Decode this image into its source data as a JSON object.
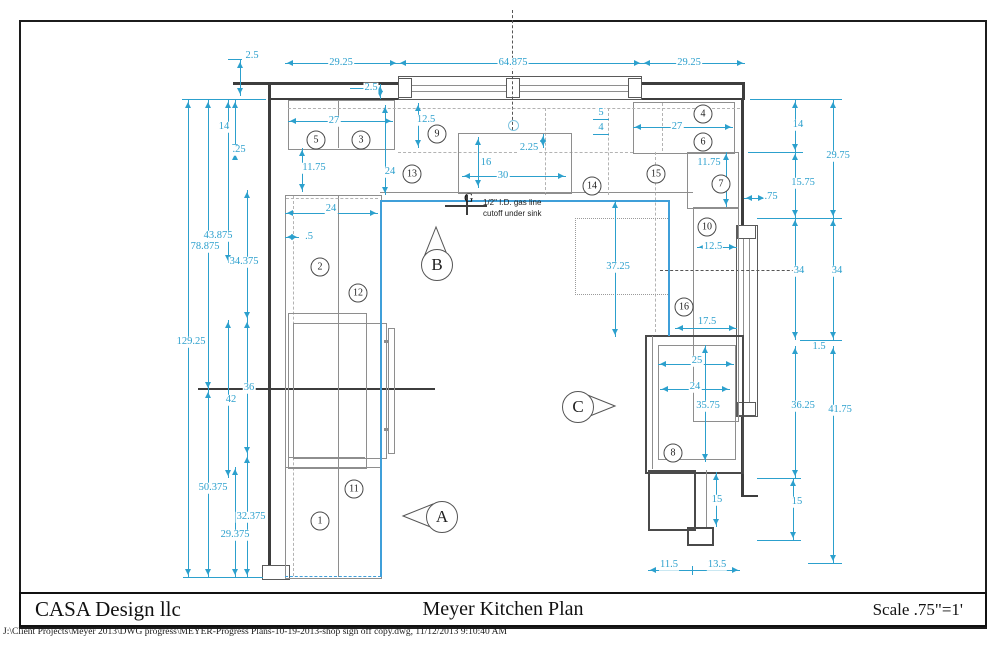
{
  "title_block": {
    "company": "CASA Design llc",
    "title": "Meyer Kitchen Plan",
    "scale": "Scale .75\"=1'"
  },
  "footer": {
    "path": "J:\\Client Projects\\Meyer 2013\\DWG progress\\MEYER-Progress Plans-10-19-2013-shop sign off copy.dwg, 11/12/2013 9:10:40 AM"
  },
  "gas_note": {
    "marker": "G",
    "line1": "1/2\" I.D. gas line",
    "line2": "cutoff under sink"
  },
  "colors": {
    "dimension_cyan": "#2ca0cd",
    "counter_blue": "#3f9fd9",
    "wall_dark": "#3d3d3d"
  },
  "section_markers": [
    {
      "label": "A",
      "dir": "left",
      "x": 441,
      "y": 516
    },
    {
      "label": "B",
      "dir": "up",
      "x": 436,
      "y": 264
    },
    {
      "label": "C",
      "dir": "right",
      "x": 577,
      "y": 406
    }
  ],
  "item_bubbles": [
    {
      "n": "1",
      "x": 320,
      "y": 521
    },
    {
      "n": "2",
      "x": 320,
      "y": 267
    },
    {
      "n": "3",
      "x": 361,
      "y": 140
    },
    {
      "n": "4",
      "x": 703,
      "y": 114
    },
    {
      "n": "5",
      "x": 316,
      "y": 140
    },
    {
      "n": "6",
      "x": 703,
      "y": 142
    },
    {
      "n": "7",
      "x": 721,
      "y": 184
    },
    {
      "n": "8",
      "x": 673,
      "y": 453
    },
    {
      "n": "9",
      "x": 437,
      "y": 134
    },
    {
      "n": "10",
      "x": 707,
      "y": 227
    },
    {
      "n": "11",
      "x": 354,
      "y": 489
    },
    {
      "n": "12",
      "x": 358,
      "y": 293
    },
    {
      "n": "13",
      "x": 412,
      "y": 174
    },
    {
      "n": "14",
      "x": 592,
      "y": 186
    },
    {
      "n": "15",
      "x": 656,
      "y": 174
    },
    {
      "n": "16",
      "x": 684,
      "y": 307
    }
  ],
  "dimensions": [
    {
      "t": "2.5",
      "x": 252,
      "y": 56
    },
    {
      "t": "29.25",
      "x": 341,
      "y": 63
    },
    {
      "t": "64.875",
      "x": 513,
      "y": 63
    },
    {
      "t": "29.25",
      "x": 689,
      "y": 63
    },
    {
      "t": "2.5",
      "x": 371,
      "y": 88
    },
    {
      "t": "27",
      "x": 334,
      "y": 121
    },
    {
      "t": "12.5",
      "x": 426,
      "y": 120
    },
    {
      "t": "11.75",
      "x": 314,
      "y": 168
    },
    {
      "t": "24",
      "x": 390,
      "y": 172
    },
    {
      "t": "16",
      "x": 486,
      "y": 163
    },
    {
      "t": "30",
      "x": 503,
      "y": 176
    },
    {
      "t": "2.25",
      "x": 529,
      "y": 148
    },
    {
      "t": "5",
      "x": 601,
      "y": 113
    },
    {
      "t": "4",
      "x": 601,
      "y": 128
    },
    {
      "t": "27",
      "x": 677,
      "y": 127
    },
    {
      "t": "11.75",
      "x": 709,
      "y": 163
    },
    {
      "t": ".75",
      "x": 771,
      "y": 197
    },
    {
      "t": "14",
      "x": 224,
      "y": 127
    },
    {
      "t": ".25",
      "x": 239,
      "y": 150
    },
    {
      "t": "43.875",
      "x": 218,
      "y": 236
    },
    {
      "t": "78.875",
      "x": 205,
      "y": 247
    },
    {
      "t": "34.375",
      "x": 244,
      "y": 262
    },
    {
      "t": "129.25",
      "x": 191,
      "y": 342
    },
    {
      "t": "36",
      "x": 249,
      "y": 388
    },
    {
      "t": "42",
      "x": 231,
      "y": 400
    },
    {
      "t": "50.375",
      "x": 213,
      "y": 488
    },
    {
      "t": "32.375",
      "x": 251,
      "y": 517
    },
    {
      "t": "29.375",
      "x": 235,
      "y": 535
    },
    {
      "t": "24",
      "x": 331,
      "y": 209
    },
    {
      "t": ".5",
      "x": 309,
      "y": 237
    },
    {
      "t": "12.5",
      "x": 713,
      "y": 247
    },
    {
      "t": "37.25",
      "x": 618,
      "y": 267
    },
    {
      "t": "17.5",
      "x": 707,
      "y": 322
    },
    {
      "t": "25",
      "x": 697,
      "y": 361
    },
    {
      "t": "24",
      "x": 695,
      "y": 387
    },
    {
      "t": "35.75",
      "x": 708,
      "y": 406
    },
    {
      "t": "15",
      "x": 717,
      "y": 500
    },
    {
      "t": "11.5",
      "x": 669,
      "y": 565
    },
    {
      "t": "13.5",
      "x": 717,
      "y": 565
    },
    {
      "t": "14",
      "x": 798,
      "y": 125
    },
    {
      "t": "29.75",
      "x": 838,
      "y": 156
    },
    {
      "t": "15.75",
      "x": 803,
      "y": 183
    },
    {
      "t": "34",
      "x": 799,
      "y": 271
    },
    {
      "t": "34",
      "x": 837,
      "y": 271
    },
    {
      "t": "1.5",
      "x": 819,
      "y": 347
    },
    {
      "t": "36.25",
      "x": 803,
      "y": 406
    },
    {
      "t": "41.75",
      "x": 840,
      "y": 410
    },
    {
      "t": "15",
      "x": 797,
      "y": 502
    }
  ]
}
